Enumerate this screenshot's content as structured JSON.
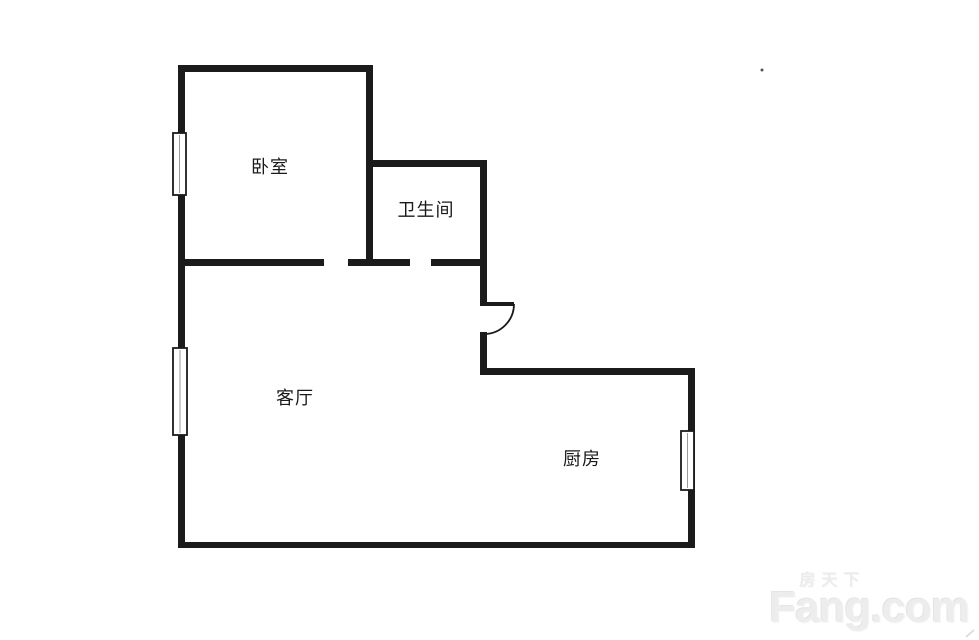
{
  "floorplan": {
    "rooms": [
      {
        "id": "bedroom",
        "label": "卧室"
      },
      {
        "id": "bathroom",
        "label": "卫生间"
      },
      {
        "id": "living-room",
        "label": "客厅"
      },
      {
        "id": "kitchen",
        "label": "厨房"
      }
    ],
    "window_count": 3,
    "door_count": 1
  },
  "watermark": {
    "cn": "房天下",
    "en": "Fang.com"
  },
  "colors": {
    "wall": "#1b1b1b",
    "label": "#1a1a1a",
    "watermark": "#ececec",
    "background": "#ffffff"
  }
}
